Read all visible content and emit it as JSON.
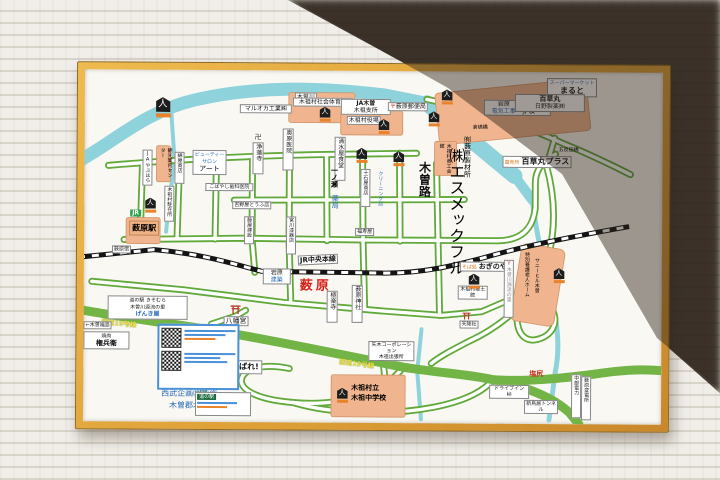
{
  "colors": {
    "frame": "#dfa137",
    "road_green": "#61a93a",
    "route19_green": "#72b445",
    "river_blue": "#8ed2dc",
    "building_orange": "#f0b58e",
    "rail_black": "#141414"
  },
  "icons": {
    "landmark": "人",
    "post": "〒",
    "manji": "卍",
    "sumo": "力",
    "monument": "Y"
  },
  "map": {
    "labels": {
      "kisogawa": "木曽川",
      "maruoka": "マルオカ工業㈱",
      "okuhara": "奥原医院",
      "jorenji": "浄蓮寺",
      "taiikukan": "木祖村社会体育館",
      "ja_kiso": "JA木曽",
      "kiso_shisho": "木祖支所",
      "post_office": "薮原郵便局",
      "sonritsu": "村立",
      "shogakko": "木祖小学校",
      "supermarket": "スーパーマーケット",
      "maruto": "まると",
      "iwahara1": "岩原",
      "denki_koji": "電気工事",
      "hyakusogan": "百草丸",
      "hino_seiyaku": "日野製薬㈱",
      "hyakusogan_plus": "百草丸プラス",
      "chokubaisho": "直売所",
      "gotanda_bashi": "五反田橋",
      "kurashima_bashi": "倉嶋橋",
      "yakuba": "木祖村役場",
      "shimizuya": "清水屋食堂",
      "shokokaikan": "木祖村商工会館",
      "jukokuya": "十石屋商店",
      "cleaning": "クリーニング店",
      "ichinose": "一ノ瀬",
      "yakkyoku": "薬局",
      "kisoji": "木曽路",
      "smec": "㈱エスメックフル",
      "seizaisho": "㈲薮原製材所",
      "miyagawa": "宮川漆器店",
      "fukujuya": "福寿屋",
      "jr": "JR",
      "yabuhara_eki": "薮原駅",
      "yabuhara_juku": "薮原宿",
      "ja_yabuhara": "JAやぶはら",
      "kanko_annai": "観光案内センター",
      "wataya": "綿屋商店",
      "beauty": "ビューティーサロン",
      "art": "アート",
      "chuzaisho": "木祖村駐在所",
      "kobayashi": "こばやし歯科医院",
      "tofuten": "吉野屋とうふ店",
      "kensetsu": "藤屋建設",
      "jr_chuo": "JR中央本線",
      "yabuhara": "薮原",
      "iwahara2": "岩原",
      "kenchiku": "建築",
      "gokurakuji": "極楽寺",
      "jinja": "薮原神社",
      "hachimangu": "八幡宮",
      "route19_1": "国道19号線",
      "kiso_fukushima": "←木曽福島",
      "yakiniku": "焼肉",
      "gonbee": "権兵衛",
      "michinoeki1": "道の駅 きそむら",
      "genryu_sato": "木曽川源流の里",
      "genkiya": "げんき屋",
      "kiso_hoshi": "木曽の星",
      "mitakeumi": "御嶽海がんばれ!",
      "seibu": "西武企画㈱製作",
      "address": "木曽郡木祖村1001",
      "michinoeki2": "道の駅",
      "yagi": "矢木コーポレーション",
      "shucchojo": "木祖出張所",
      "route19_2": "国道19号線",
      "sonritsu2": "木祖村立",
      "chugakko": "木祖中学校",
      "sobadokoro": "そば処",
      "oginoya": "おぎのや",
      "tokuyo": "特別養護老人ホーム",
      "sunnyhill": "サニーヒル木曽",
      "genryu_monument": "木曽川源流の里",
      "kyodokan": "木祖村郷土館",
      "tenkosha": "天降社",
      "shiojiri": "塩尻",
      "chubu_denryoku": "中部電力",
      "hendensho": "薮原変電所",
      "drivein": "ドライブイン",
      "toge": "峠",
      "tunnel": "新鳥居トンネル"
    }
  }
}
